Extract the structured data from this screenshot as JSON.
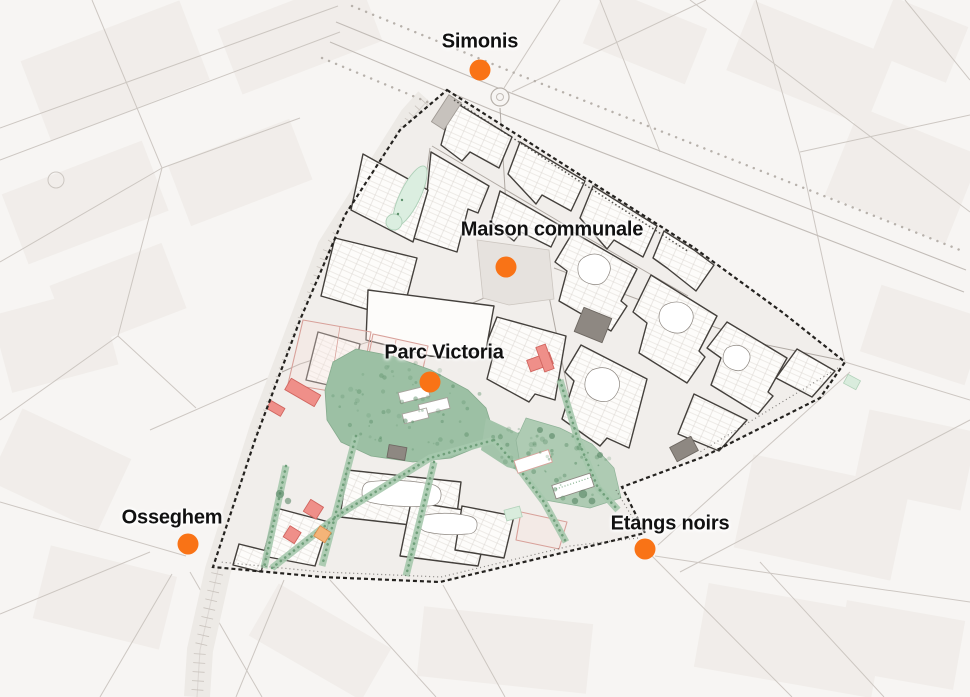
{
  "figure": {
    "description": "Urban district plan map with metro station markers",
    "background": "#f7f5f3",
    "district_fill": "#f1eeeb",
    "block_fill": "#fdfcfa",
    "block_outline": "#44403c",
    "boundary_color": "#24221f",
    "park_green": "#9cc0a4",
    "corridor_green": "#a7c9ae",
    "tree_green": "#5f916c",
    "mint_green": "#dbeee0",
    "building_red": "#ef8f89",
    "building_orange": "#f4b478",
    "building_dark_gray": "#8e8882",
    "building_light_gray": "#c7c2bd",
    "pink_parcel_outline": "#d8a19a",
    "street_line": "#c8c2bd",
    "marker_color": "#f97316",
    "label_color": "#111111"
  },
  "markers": [
    {
      "id": "simonis",
      "label": "Simonis",
      "dot": {
        "x": 480,
        "y": 70
      },
      "label_pos": {
        "x": 480,
        "y": 42
      }
    },
    {
      "id": "maison-communale",
      "label": "Maison communale",
      "dot": {
        "x": 506,
        "y": 267
      },
      "label_pos": {
        "x": 552,
        "y": 230
      }
    },
    {
      "id": "parc-victoria",
      "label": "Parc Victoria",
      "dot": {
        "x": 430,
        "y": 382
      },
      "label_pos": {
        "x": 444,
        "y": 353
      }
    },
    {
      "id": "osseghem",
      "label": "Osseghem",
      "dot": {
        "x": 188,
        "y": 544
      },
      "label_pos": {
        "x": 172,
        "y": 518
      }
    },
    {
      "id": "etangs-noirs",
      "label": "Etangs noirs",
      "dot": {
        "x": 645,
        "y": 549
      },
      "label_pos": {
        "x": 670,
        "y": 524
      }
    }
  ]
}
